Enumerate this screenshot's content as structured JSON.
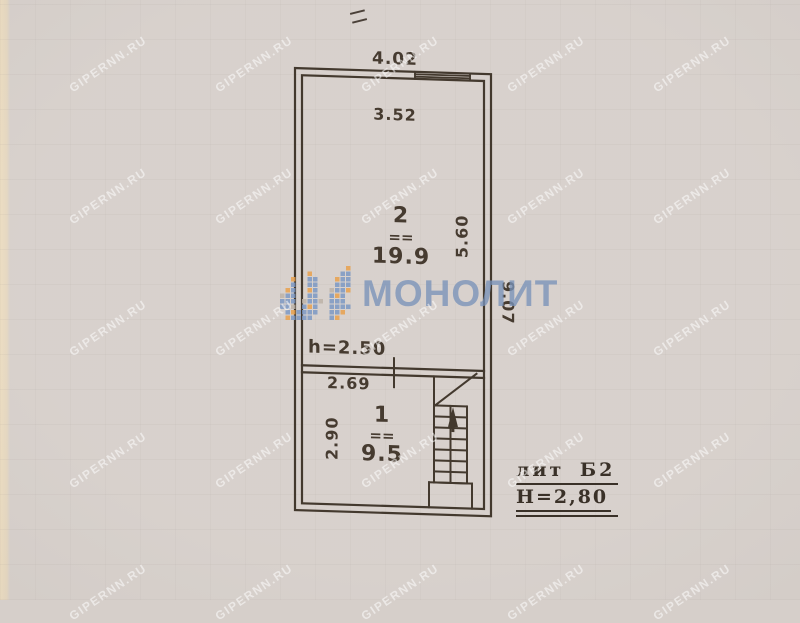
{
  "watermark": {
    "text": "GIPERNN.RU"
  },
  "brand": {
    "name": "МОНОЛИТ",
    "colors": {
      "blue": "#7d99c4",
      "orange": "#e9a24e",
      "gray": "#bdb3a8"
    }
  },
  "colors": {
    "ink": "#43392e",
    "paper": "#d6cfca",
    "paper_edge": "#e8dbc5",
    "watermark_text": "rgba(255,255,255,0.52)"
  },
  "plan": {
    "dimensions": {
      "outer_width_top": "4.02",
      "inner_width_top": "3.52",
      "inner_height_right": "5.60",
      "outer_height_right": "9.07",
      "ceiling_height": "h=2.50",
      "inner_width_middle": "2.69",
      "inner_height_left": "2.90"
    },
    "room_separator": "==",
    "rooms": [
      {
        "number": "2",
        "area": "19.9"
      },
      {
        "number": "1",
        "area": "9.5"
      }
    ],
    "annotation": {
      "liter": "лит Б2",
      "building_height": "Н=2,80"
    }
  }
}
